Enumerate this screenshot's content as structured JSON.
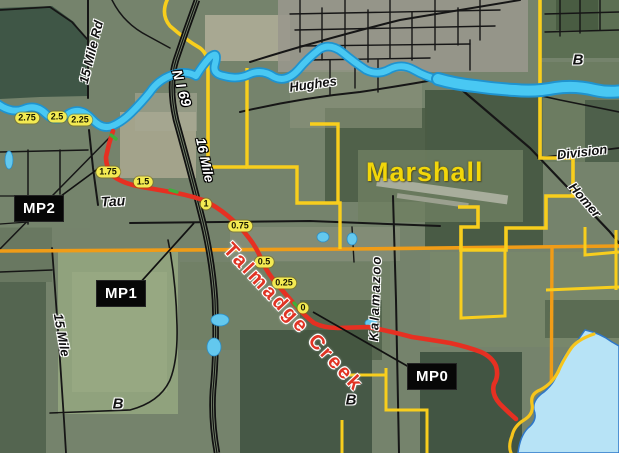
{
  "map": {
    "place_labels": {
      "city": "Marshall",
      "creek": "Talmadge Creek",
      "township_b_northeast": "B",
      "township_b_southwest": "B",
      "township_b_south_central": "B",
      "tau": "Tau"
    },
    "road_labels": {
      "fifteen_mile_rd": "15 Mile Rd",
      "n_i_69": "N I 69",
      "sixteen_mile": "16 Mile",
      "hughes": "Hughes",
      "division": "Division",
      "homer": "Homer",
      "kalamazoo": "Kalamazoo",
      "fifteen_mile": "15 Mile"
    },
    "milepost_markers": [
      "2.75",
      "2.5",
      "2.25",
      "1.75",
      "1.5",
      "1",
      "0.75",
      "0.5",
      "0.25",
      "0"
    ],
    "mp_callouts": [
      {
        "label": "MP2"
      },
      {
        "label": "MP1"
      },
      {
        "label": "MP0"
      }
    ],
    "colors": {
      "pipeline_route": "#e63022",
      "river": "#49c8f3",
      "lake": "#b7e3f6",
      "milepost_pill": "#f3ea52",
      "boundary_yellow": "#f8ce1d",
      "major_road_orange": "#f09c17",
      "city_label_yellow": "#f2d60a",
      "creek_label_red": "#e03424"
    }
  }
}
